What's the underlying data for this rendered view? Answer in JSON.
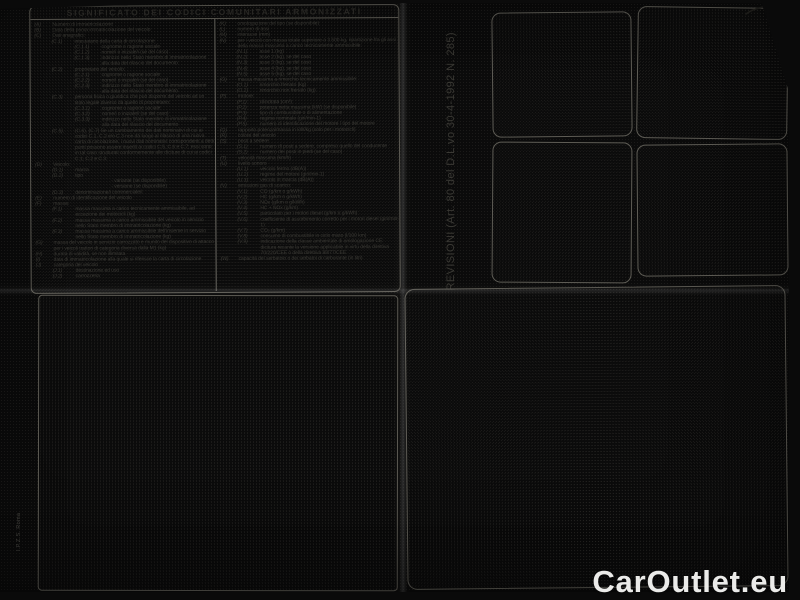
{
  "document": {
    "title": "SIGNIFICATO DEI CODICI COMUNITARI ARMONIZZATI",
    "left_column": [
      {
        "c": "(A)",
        "t": "Numero di immatricolazione",
        "i": 0
      },
      {
        "c": "(B)",
        "t": "Data della prima immatricolazione del veicolo",
        "i": 0
      },
      {
        "c": "(C)",
        "t": "Dati anagrafici:",
        "i": 0
      },
      {
        "c": "(C.1)",
        "t": "intestatario della carta di circolazione:",
        "i": 1
      },
      {
        "c": "(C.1.1)",
        "t": "cognome o ragione sociale",
        "i": 2
      },
      {
        "c": "(C.1.2)",
        "t": "nome/i o iniziale/i (se del caso)",
        "i": 2
      },
      {
        "c": "(C.1.3)",
        "t": "indirizzo nello Stato membro di immatricolazione alla data del rilascio del documento",
        "i": 2
      },
      {
        "c": "(C.2)",
        "t": "proprietario del veicolo:",
        "i": 1
      },
      {
        "c": "(C.2.1)",
        "t": "cognome o ragione sociale",
        "i": 2
      },
      {
        "c": "(C.2.2)",
        "t": "nome/i o iniziale/i (se del caso)",
        "i": 2
      },
      {
        "c": "(C.2.3)",
        "t": "indirizzo nello Stato membro di immatricolazione alla data del rilascio del documento",
        "i": 2
      },
      {
        "c": "(C.3)",
        "t": "persona fisica o giuridica che può disporre del veicolo ad un titolo legale diverso da quello di proprietario:",
        "i": 1
      },
      {
        "c": "(C.3.1)",
        "t": "cognome o ragione sociale",
        "i": 2
      },
      {
        "c": "(C.3.2)",
        "t": "nome/i o iniziale/i (se del caso)",
        "i": 2
      },
      {
        "c": "(C.3.3)",
        "t": "indirizzo nello Stato membro di immatricolazione alla data del rilascio del documento",
        "i": 2
      },
      {
        "c": "(C.5),",
        "t": "(C.6), (C.7) Se un cambiamento dei dati nominativi di cui ai codici C.1, C.2 e/o C.3 non dà luogo al rilascio di una nuova carta di circolazione, i nuovi dati nominativi corrispondenti a detti punti possono essere inseriti ai codici C.5, C.6 e C.7; essi sono in tal caso strutturati conformemente alle diciture di cui ai codici C.1, C.2 e C.3.",
        "i": 1
      },
      {
        "c": "(D)",
        "t": "Veicolo:",
        "i": 0
      },
      {
        "c": "(D.1)",
        "t": "marca",
        "i": 1
      },
      {
        "c": "(D.2)",
        "t": "tipo",
        "i": 1
      },
      {
        "c": "",
        "t": "- variante (se disponibile)",
        "i": 3
      },
      {
        "c": "",
        "t": "- versione (se disponibile)",
        "i": 3
      },
      {
        "c": "(D.3)",
        "t": "denominazione/i commerciale/i",
        "i": 1
      },
      {
        "c": "(E)",
        "t": "numero di identificazione del veicolo",
        "i": 0
      },
      {
        "c": "(F)",
        "t": "massa:",
        "i": 0
      },
      {
        "c": "(F.1)",
        "t": "massa massima a carico tecnicamente ammissibile, ad eccezione dei motocicli (kg)",
        "i": 1
      },
      {
        "c": "(F.2)",
        "t": "massa massima a carico ammissibile del veicolo in servizio nello Stato membro di immatricolazione (kg)",
        "i": 1
      },
      {
        "c": "(F.3)",
        "t": "massa massima a carico ammissibile dell'insieme in servizio nello Stato membro di immatricolazione (kg)",
        "i": 1
      },
      {
        "c": "(G)",
        "t": "massa del veicolo in servizio carrozzato e munito del dispositivo di attacco per i veicoli trattori di categoria diversa dalla M1 (kg)",
        "i": 0
      },
      {
        "c": "(H)",
        "t": "durata di validità, se non illimitata",
        "i": 0
      },
      {
        "c": "(I)",
        "t": "data di immatricolazione alla quale si riferisce la carta di circolazione",
        "i": 0
      },
      {
        "c": "(J)",
        "t": "categoria del veicolo",
        "i": 0
      },
      {
        "c": "(J.1)",
        "t": "destinazione ed uso",
        "i": 1
      },
      {
        "c": "(J.2)",
        "t": "carrozzeria",
        "i": 1
      }
    ],
    "right_column": [
      {
        "c": "(K)",
        "t": "omologazione del tipo (se disponibile)",
        "i": 0
      },
      {
        "c": "(L)",
        "t": "numero di assi",
        "i": 0
      },
      {
        "c": "(M)",
        "t": "interasse (mm)",
        "i": 0
      },
      {
        "c": "(N)",
        "t": "per i veicoli con massa totale superiore a 3.500 kg, ripartizione fra gli assi della massa massima a carico tecnicamente ammissibile:",
        "i": 0
      },
      {
        "c": "(N.1)",
        "t": "asse 1 (kg)",
        "i": 1
      },
      {
        "c": "(N.2)",
        "t": "asse 2 (kg), se del caso",
        "i": 1
      },
      {
        "c": "(N.3)",
        "t": "asse 3 (kg), se del caso",
        "i": 1
      },
      {
        "c": "(N.4)",
        "t": "asse 4 (kg), se del caso",
        "i": 1
      },
      {
        "c": "(N.5)",
        "t": "asse 5 (kg), se del caso",
        "i": 1
      },
      {
        "c": "(O)",
        "t": "massa massima a rimorchio tecnicamente ammissibile:",
        "i": 0
      },
      {
        "c": "(O.1)",
        "t": "rimorchio frenato (kg)",
        "i": 1
      },
      {
        "c": "(O.2)",
        "t": "rimorchio non frenato (kg)",
        "i": 1
      },
      {
        "c": "(P)",
        "t": "motore:",
        "i": 0
      },
      {
        "c": "(P.1)",
        "t": "cilindrata (cm³)",
        "i": 1
      },
      {
        "c": "(P.2)",
        "t": "potenza netta massima (kW) (se disponibile)",
        "i": 1
      },
      {
        "c": "(P.3)",
        "t": "tipo di combustibile o di alimentazione",
        "i": 1
      },
      {
        "c": "(P.4)",
        "t": "regime nominale (giri/min-1)",
        "i": 1
      },
      {
        "c": "(P.5)",
        "t": "numero di identificazione del motore / tipo del motore",
        "i": 1
      },
      {
        "c": "(Q)",
        "t": "rapporto potenza/massa in kW/kg (solo per i motocicli)",
        "i": 0
      },
      {
        "c": "(R)",
        "t": "colore del veicolo",
        "i": 0
      },
      {
        "c": "(S)",
        "t": "posti a sedere",
        "i": 0
      },
      {
        "c": "(S.1)",
        "t": "numero di posti a sedere, compreso quello del conducente",
        "i": 1
      },
      {
        "c": "(S.2)",
        "t": "numero dei posti in piedi (se del caso)",
        "i": 1
      },
      {
        "c": "(T)",
        "t": "velocità massima (km/h)",
        "i": 0
      },
      {
        "c": "(U)",
        "t": "livello sonoro",
        "i": 0
      },
      {
        "c": "(U.1)",
        "t": "veicolo fermo (dB(A))",
        "i": 1
      },
      {
        "c": "(U.2)",
        "t": "regime del motore (giri/min-1)",
        "i": 1
      },
      {
        "c": "(U.3)",
        "t": "veicolo in marcia (dB(A))",
        "i": 1
      },
      {
        "c": "(V)",
        "t": "emissioni gas di scarico:",
        "i": 0
      },
      {
        "c": "(V.1)",
        "t": "CO (g/km o g/kWh)",
        "i": 1
      },
      {
        "c": "(V.2)",
        "t": "HC (g/km o g/kWh)",
        "i": 1
      },
      {
        "c": "(V.3)",
        "t": "NOx (g/km o g/kWh)",
        "i": 1
      },
      {
        "c": "(V.4)",
        "t": "HC + NOx (g/km)",
        "i": 1
      },
      {
        "c": "(V.5)",
        "t": "particolato per i motori diesel (g/km o g/kWh)",
        "i": 1
      },
      {
        "c": "(V.6)",
        "t": "coefficiente di assorbimento corretto per i motori diesel (giri/min-1)",
        "i": 1
      },
      {
        "c": "(V.7)",
        "t": "CO₂ (g/km)",
        "i": 1
      },
      {
        "c": "(V.8)",
        "t": "consumo di combustibile in ciclo misto (l/100 km)",
        "i": 1
      },
      {
        "c": "(V.9)",
        "t": "indicazione della classe ambientale di omologazione CE: dicitura recante la versione applicabile in virtù della direttiva 70/220/CEE o della direttiva 88/77/CEE",
        "i": 1
      },
      {
        "c": "(W)",
        "t": "capacità del serbatoio o dei serbatoi di carburante (in litri)",
        "i": 0
      }
    ],
    "revisioni_label": "REVISIONI (Art. 80 del D.L.vo 30-4-1992 N. 285)",
    "imprint": "I.P.Z.S. Roma"
  },
  "watermark": "CarOutlet.eu",
  "colors": {
    "paper": "#d6d5d0",
    "ink": "#3c3b36",
    "line": "#5e5c55",
    "photo_background": "#0b0b0b",
    "watermark": "#f8f8f5"
  }
}
